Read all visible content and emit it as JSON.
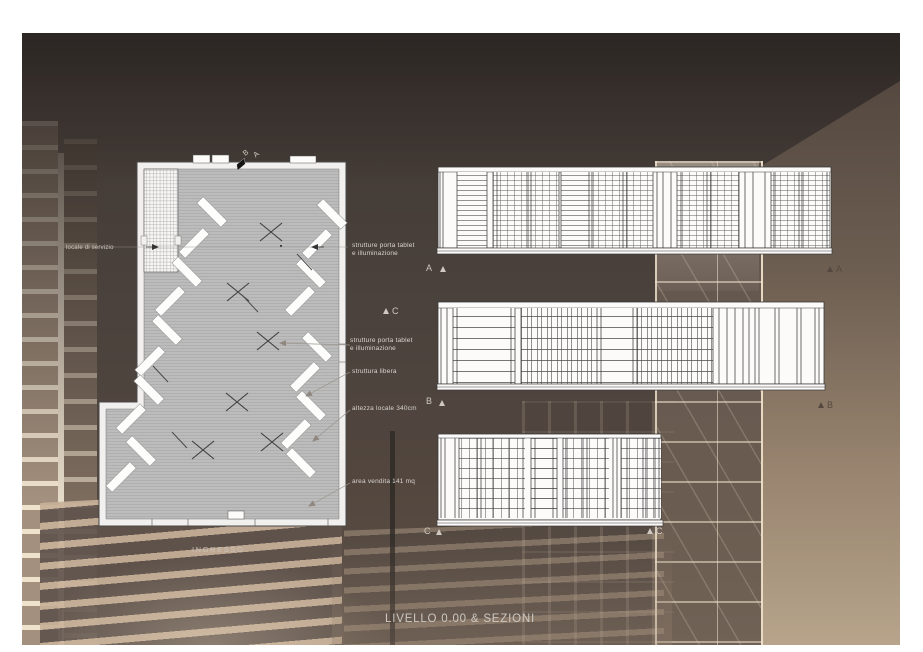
{
  "board": {
    "title": "LIVELLO 0.00 & SEZIONI"
  },
  "plan": {
    "labels": {
      "service_room": "locale di servizio",
      "entrance": "INGRESSO",
      "tablet1_l1": "strutture porta tablet",
      "tablet1_l2": "e illuminazione",
      "tablet2_l1": "strutture porta tablet",
      "tablet2_l2": "e illuminazione",
      "free_structure": "struttura libera",
      "height": "altezza locale 340cm",
      "area": "area vendita 141 mq"
    },
    "cut_marker": {
      "b": "B",
      "a": "A"
    }
  },
  "sections": {
    "a_left": "A",
    "a_right": "A",
    "b_left": "B",
    "b_right": "B",
    "c_left": "C",
    "c_right": "C",
    "c_mid": "C"
  },
  "colors": {
    "render_dark": "#4a423d",
    "render_beige": "#b7a48b",
    "shelf_cream": "#f0e3ce",
    "plan_floor": "#bcbcbc",
    "drawing_line": "#3a3a3a",
    "label_text": "#d9d4cf"
  }
}
